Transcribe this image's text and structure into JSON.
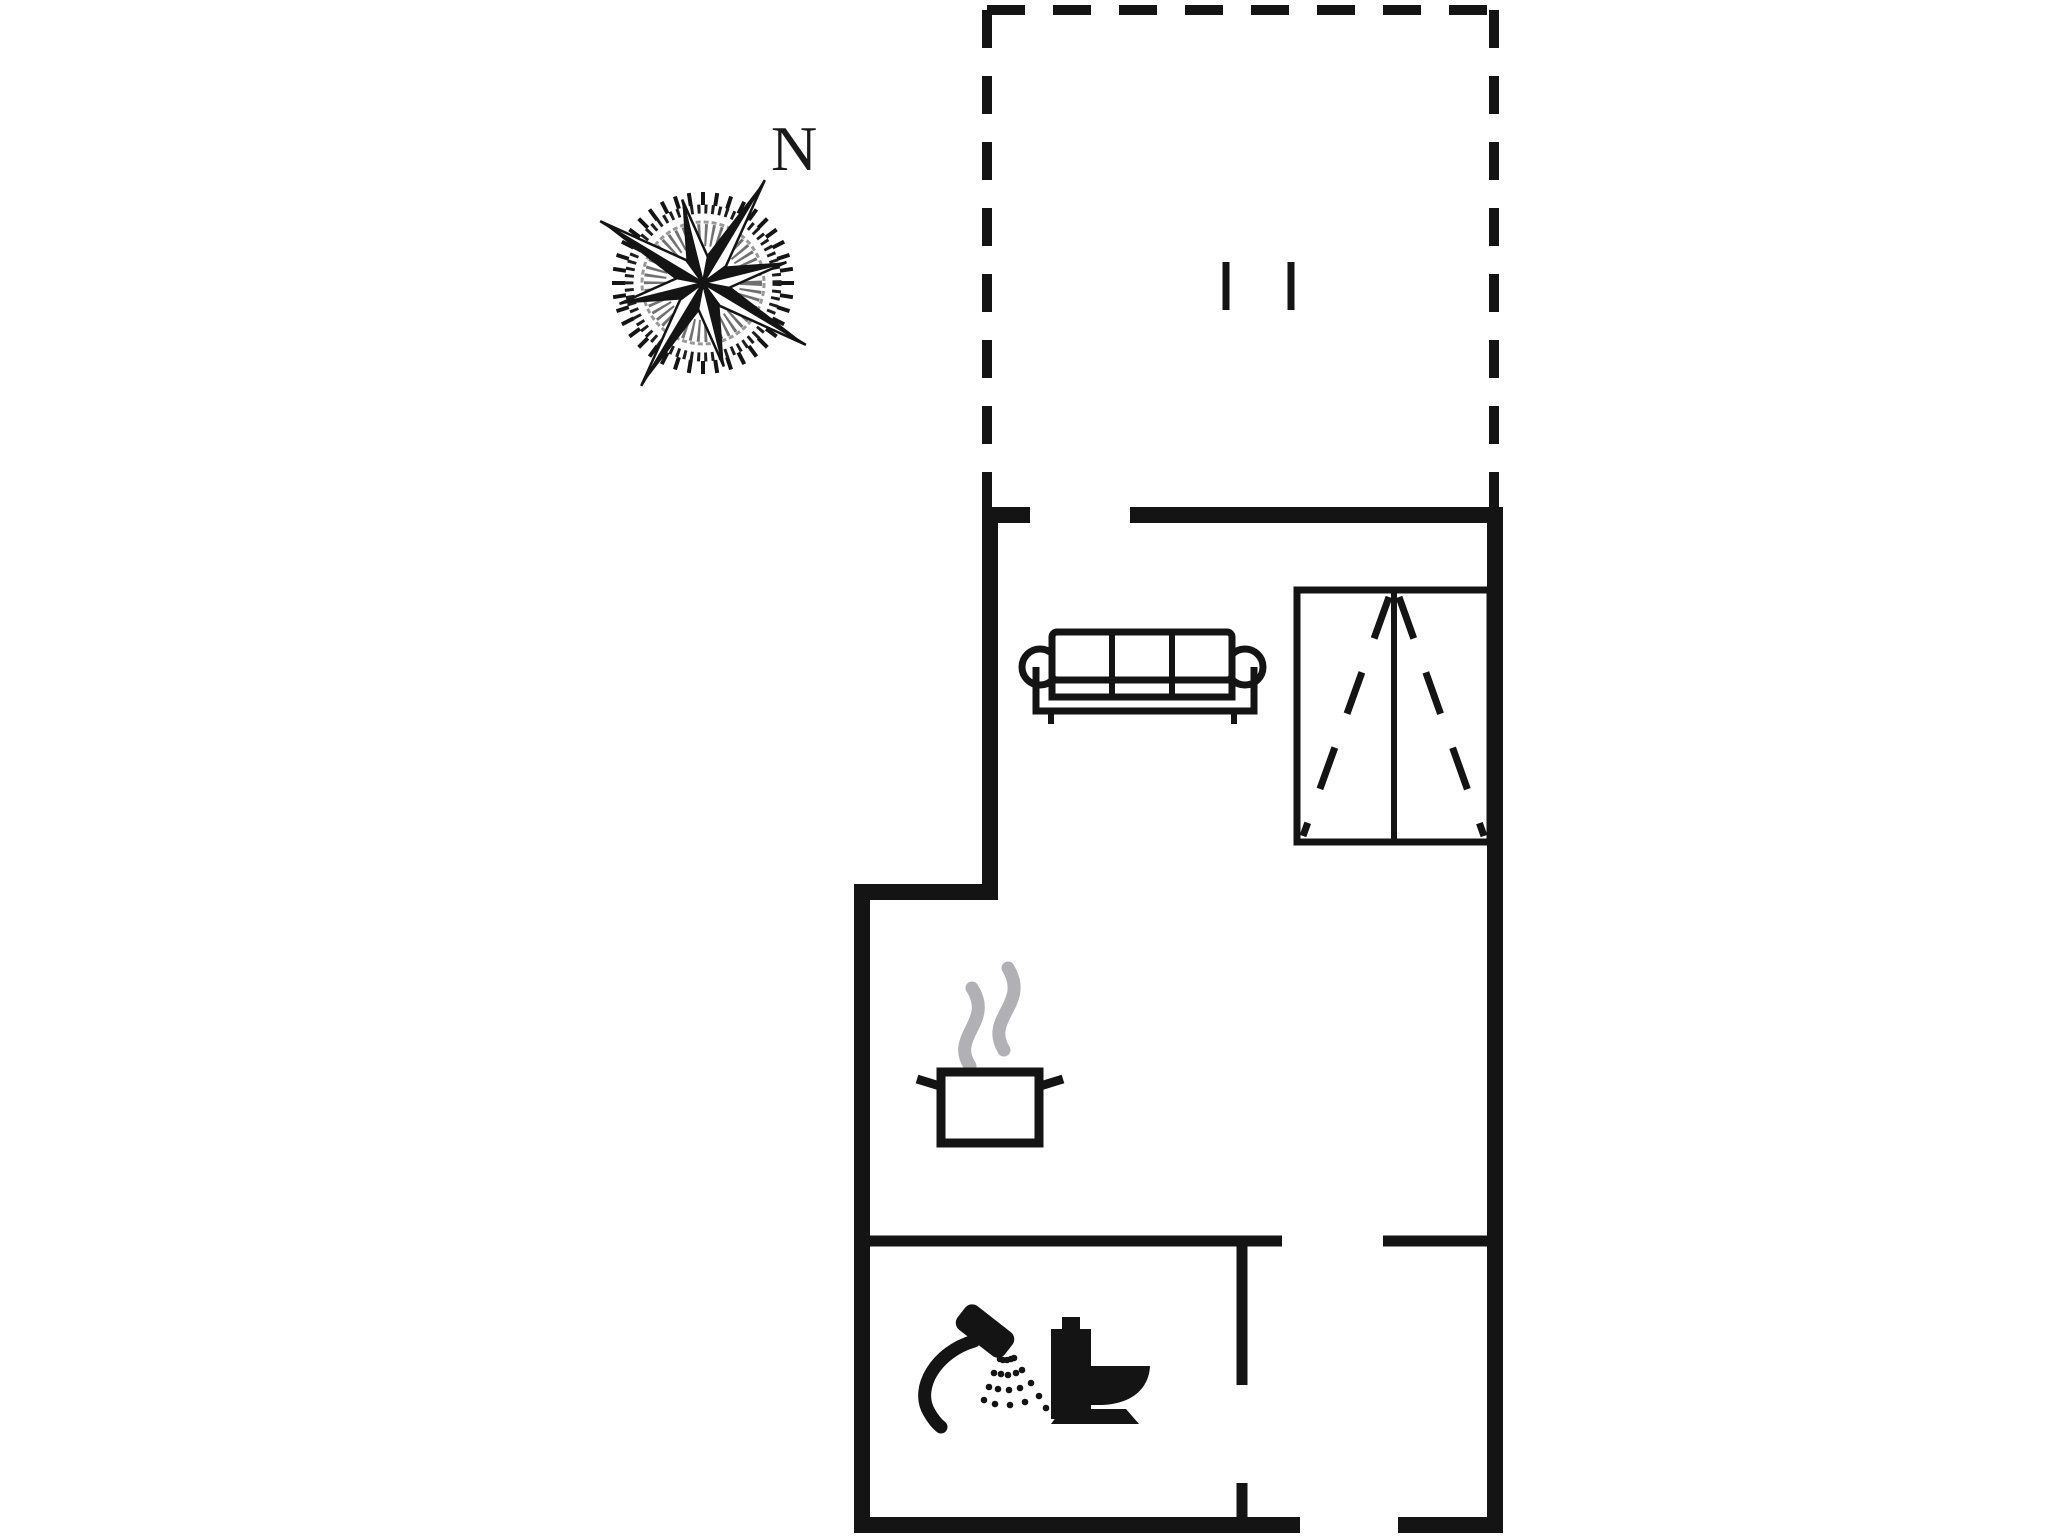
{
  "compass": {
    "north_label": "N"
  },
  "colors": {
    "line": "#141414",
    "steam": "#b1b1b5",
    "background": "#ffffff"
  },
  "icons": {
    "compass-rose": "eight-point star with tick ring, long needles on tilted diagonals",
    "north-label": "serif capital N above compass needle",
    "terrace-outline": "dashed rectangle attached to top of dwelling",
    "terrace-marker-ticks": "two short vertical dashes inside terrace",
    "sofa-icon": "three-cushion sofa, front view, round armrests, two legs",
    "wardrobe-icon": "double-door wardrobe with dashed door-swing diagonals",
    "cooking-pot-icon": "cooking pot with two side handles",
    "steam-icon": "two grey steam wisps above pot",
    "shower-icon": "hand shower with curved hose and dotted spray",
    "toilet-icon": "toilet side-view silhouette with cistern and base"
  }
}
